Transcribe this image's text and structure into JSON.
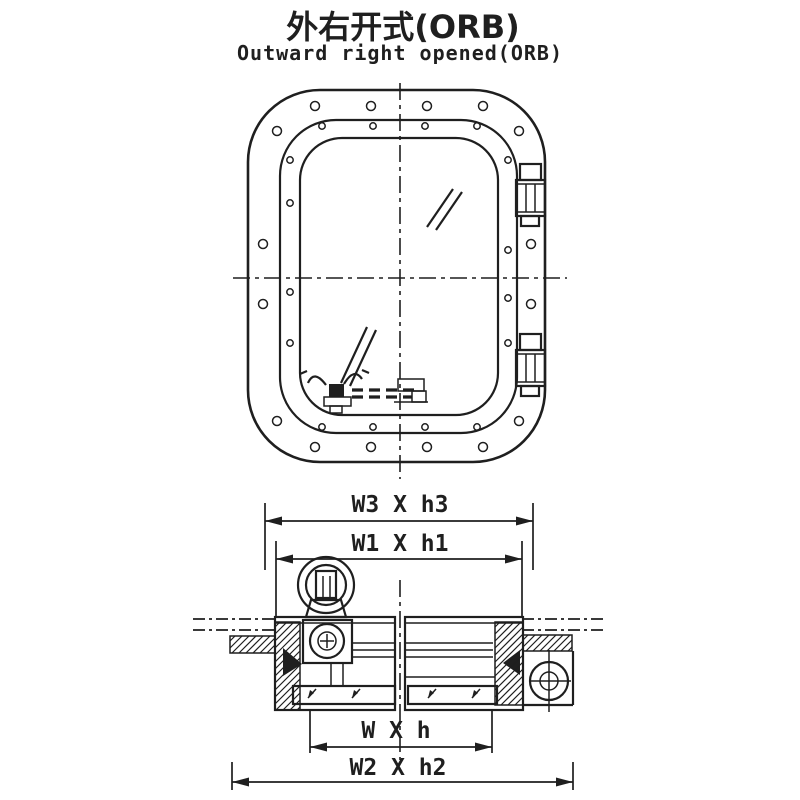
{
  "title": {
    "zh": "外右开式(ORB)",
    "en": "Outward right opened(ORB)"
  },
  "colors": {
    "line": "#1f1f1f",
    "background": "#ffffff"
  },
  "diagram_geometry": {
    "front": {
      "center_v": {
        "x": 400,
        "y1": 83,
        "y2": 479
      },
      "center_h": {
        "y": 278,
        "x1": 233,
        "x2": 567
      },
      "outer_frame": {
        "x": 248,
        "y": 90,
        "w": 297,
        "h": 372,
        "r": 72
      },
      "middle_frame": {
        "x": 280,
        "y": 120,
        "w": 237,
        "h": 313,
        "r": 56
      },
      "glass_frame": {
        "x": 300,
        "y": 138,
        "w": 198,
        "h": 277,
        "r": 42
      },
      "outer_bolts": [
        [
          315,
          106
        ],
        [
          371,
          106
        ],
        [
          427,
          106
        ],
        [
          483,
          106
        ],
        [
          315,
          447
        ],
        [
          371,
          447
        ],
        [
          427,
          447
        ],
        [
          483,
          447
        ],
        [
          263,
          244
        ],
        [
          263,
          304
        ],
        [
          531,
          244
        ],
        [
          531,
          304
        ],
        [
          277,
          131
        ],
        [
          519,
          131
        ],
        [
          277,
          421
        ],
        [
          519,
          421
        ]
      ],
      "outer_bolt_r": 4.5,
      "cover_bolts": [
        [
          322,
          126
        ],
        [
          373,
          126
        ],
        [
          425,
          126
        ],
        [
          477,
          126
        ],
        [
          322,
          427
        ],
        [
          373,
          427
        ],
        [
          425,
          427
        ],
        [
          477,
          427
        ],
        [
          290,
          160
        ],
        [
          290,
          203
        ],
        [
          290,
          292
        ],
        [
          290,
          343
        ],
        [
          508,
          160
        ],
        [
          508,
          250
        ],
        [
          508,
          298
        ],
        [
          508,
          343
        ]
      ],
      "cover_bolt_r": 3.2,
      "hinges": [
        164,
        334
      ],
      "glass_marks": [
        [
          427,
          227,
          453,
          189
        ],
        [
          436,
          230,
          462,
          192
        ],
        [
          341,
          383,
          367,
          327
        ],
        [
          350,
          386,
          376,
          330
        ]
      ]
    },
    "section": {
      "center_v": {
        "x": 400,
        "y1": 580,
        "y2": 760
      },
      "phantom_lines": [
        [
          193,
          619,
          276,
          619
        ],
        [
          193,
          630,
          276,
          630
        ],
        [
          522,
          619,
          607,
          619
        ],
        [
          522,
          630,
          607,
          630
        ]
      ],
      "hatches": [
        {
          "x": 275,
          "y": 622,
          "w": 25,
          "h": 88
        },
        {
          "x": 230,
          "y": 636,
          "w": 45,
          "h": 17
        },
        {
          "x": 495,
          "y": 622,
          "w": 28,
          "h": 83
        },
        {
          "x": 523,
          "y": 635,
          "w": 49,
          "h": 16
        }
      ],
      "clamp_ticks": [
        [
          316,
          689
        ],
        [
          360,
          689
        ],
        [
          436,
          689
        ],
        [
          480,
          689
        ]
      ]
    },
    "dimensions": [
      {
        "id": "w3h3",
        "label": "W3 X h3",
        "x1": 265,
        "x2": 533,
        "y": 521,
        "text_x": 400,
        "text_y": 512,
        "ext_y1": 503,
        "ext_y2": 570
      },
      {
        "id": "w1h1",
        "label": "W1 X h1",
        "x1": 276,
        "x2": 522,
        "y": 559,
        "text_x": 400,
        "text_y": 551,
        "ext_y1": 541,
        "ext_y2": 616
      },
      {
        "id": "wh",
        "label": "W X h",
        "x1": 310,
        "x2": 492,
        "y": 747,
        "text_x": 396,
        "text_y": 738,
        "ext_y1": 709,
        "ext_y2": 753
      },
      {
        "id": "w2h2",
        "label": "W2 X h2",
        "x1": 232,
        "x2": 573,
        "y": 782,
        "text_x": 398,
        "text_y": 775,
        "ext_y1": 762,
        "ext_y2": 790
      }
    ]
  }
}
